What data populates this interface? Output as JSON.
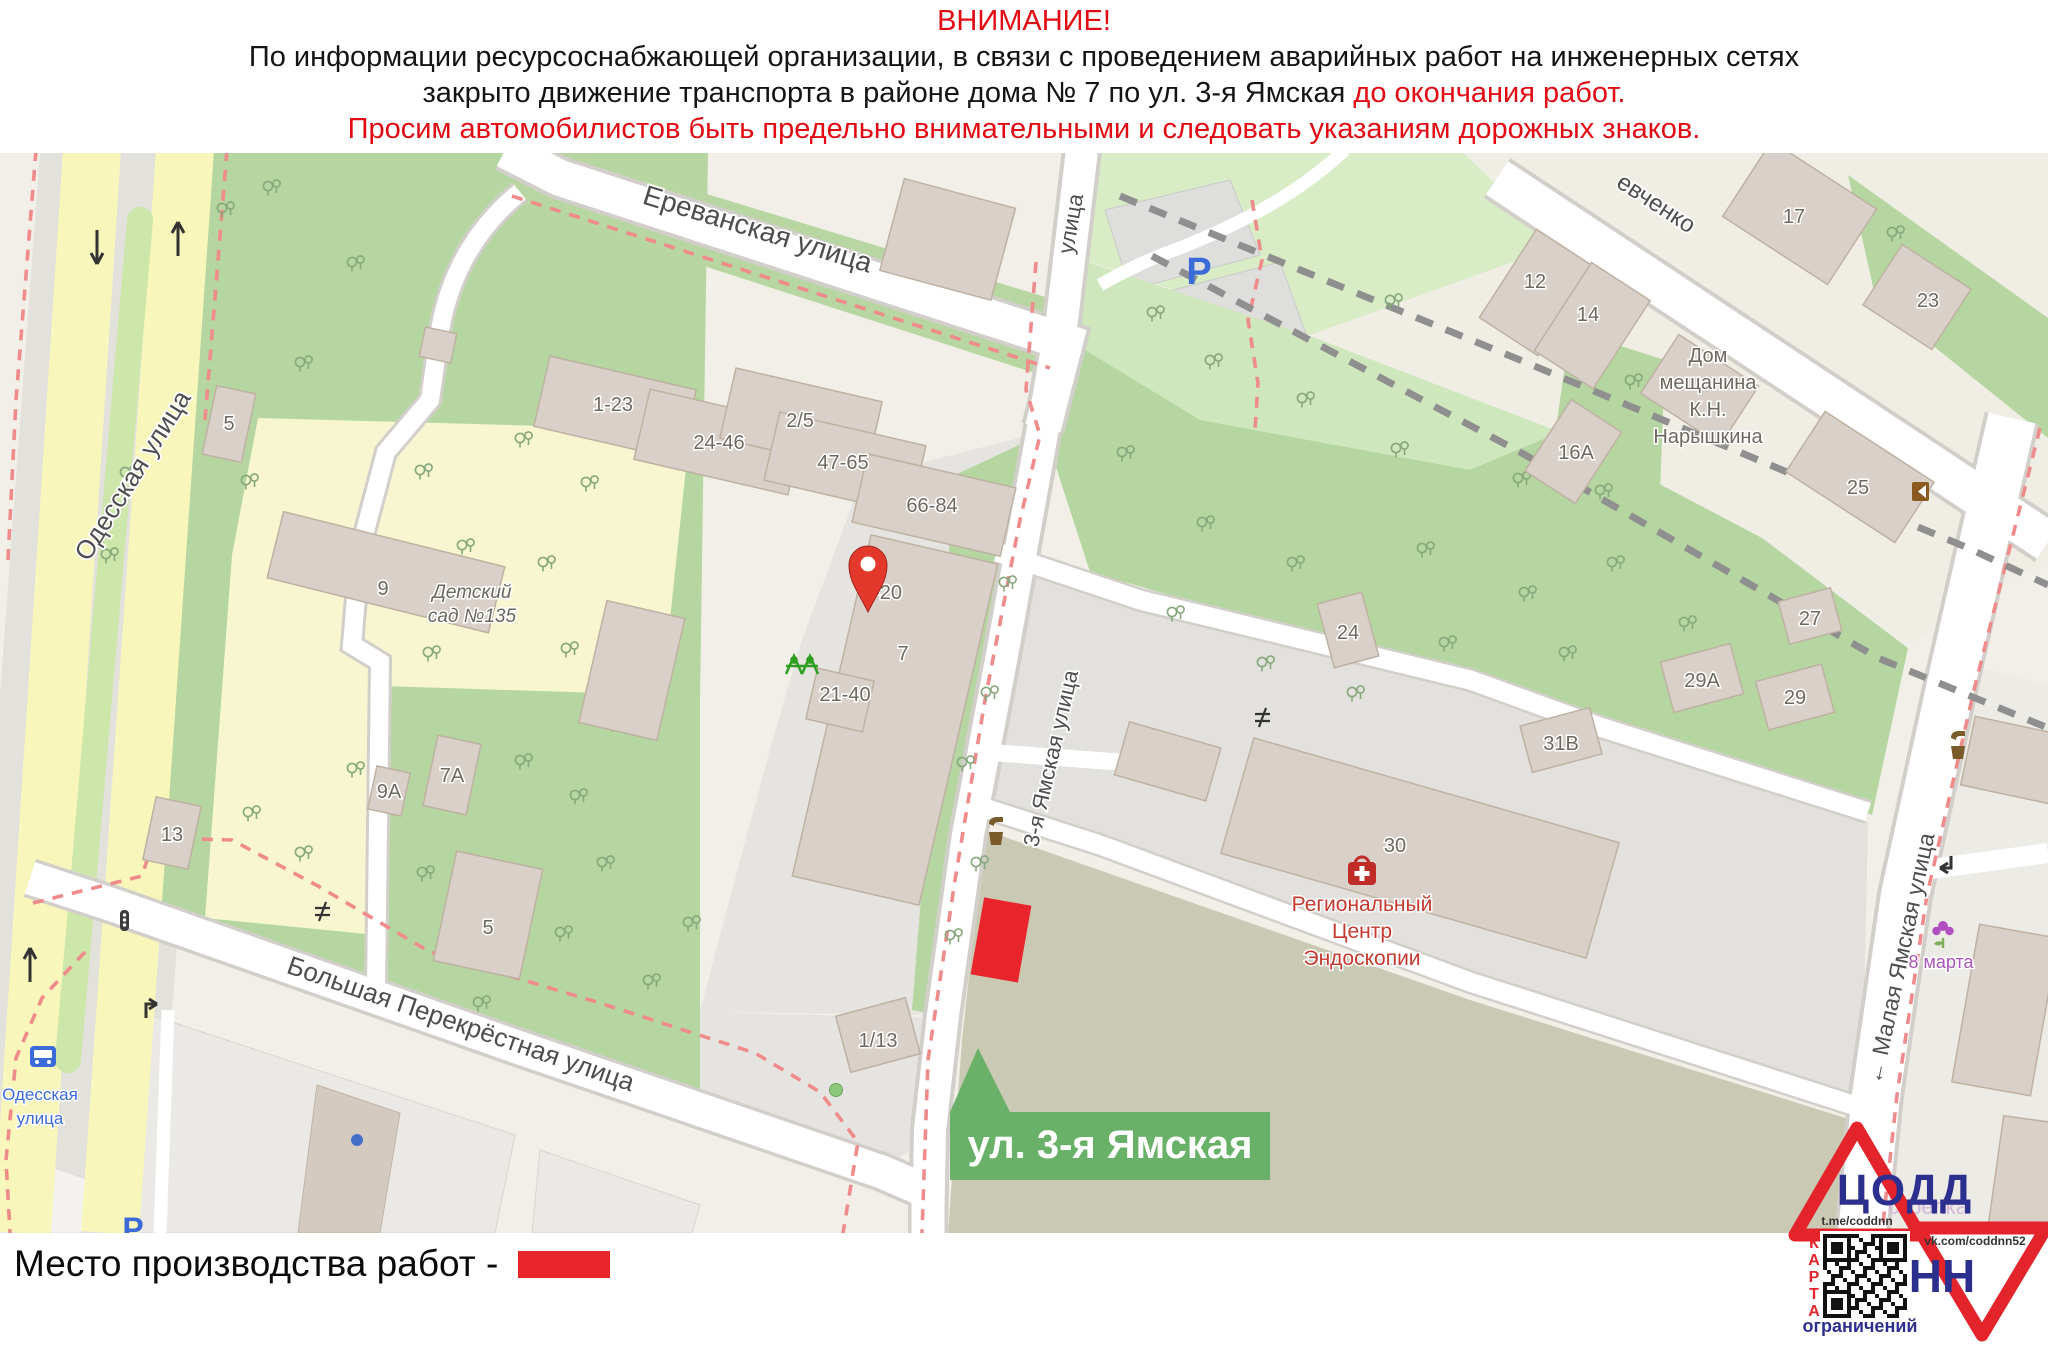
{
  "header": {
    "title": "ВНИМАНИЕ!",
    "line2": "По информации ресурсоснабжающей организации, в связи с проведением аварийных работ на инженерных сетях",
    "line3_black": "закрыто движение транспорта в районе дома № 7 по ул. 3-я Ямская",
    "line3_red": "до окончания работ.",
    "line4": "Просим автомобилистов быть предельно внимательными и следовать указаниям дорожных знаков."
  },
  "legend": {
    "label": "Место производства работ  -",
    "swatch_color": "#e8252a"
  },
  "map": {
    "streets": {
      "erevanskaya": "Ереванская улица",
      "odesskaya": "Одесская улица",
      "yamskaya3": "3-я Ямская улица",
      "yamskaya3_top": "улица",
      "bolshaya": "Большая Перекрёстная улица",
      "malaya": "← Малая Ямская улица",
      "shevchenko": "евченко"
    },
    "bus_stop": {
      "line1": "Одесская",
      "line2": "улица"
    },
    "callout": {
      "text": "ул. 3-я Ямская",
      "color": "#69b169"
    },
    "poi": {
      "kindergarten1": "Детский",
      "kindergarten2": "сад №135",
      "naryshkin": [
        "Дом",
        "мещанина",
        "К.Н.",
        "Нарышкина"
      ],
      "endoscopy": [
        "Региональный",
        "Центр",
        "Эндоскопии"
      ],
      "march8": "8 марта",
      "parking": "P",
      "parking_south": "P"
    },
    "buildings": {
      "b1_23": "1-23",
      "b24_46": "24-46",
      "b2_5": "2/5",
      "b47_65": "47-65",
      "b66_84": "66-84",
      "b7": "7",
      "b1_20": "1-20",
      "b21_40": "21-40",
      "b9": "9",
      "b5kg": "5",
      "b5top": "5",
      "b13": "13",
      "b9a": "9А",
      "b7a": "7А",
      "b24": "24",
      "b29a": "29А",
      "b29": "29",
      "b31v": "31В",
      "b27": "27",
      "b30": "30",
      "b12": "12",
      "b14": "14",
      "b17": "17",
      "b23": "23",
      "b25": "25",
      "b16a": "16А",
      "b1_13": "1/13"
    }
  },
  "logo": {
    "org": "ЦОДД",
    "city": "НН",
    "telegram": "t.me/coddnn",
    "vk": "vk.com/coddnn52",
    "karta": "КАРТА",
    "restrictions": "ограничений",
    "watermark": "стрелка"
  }
}
